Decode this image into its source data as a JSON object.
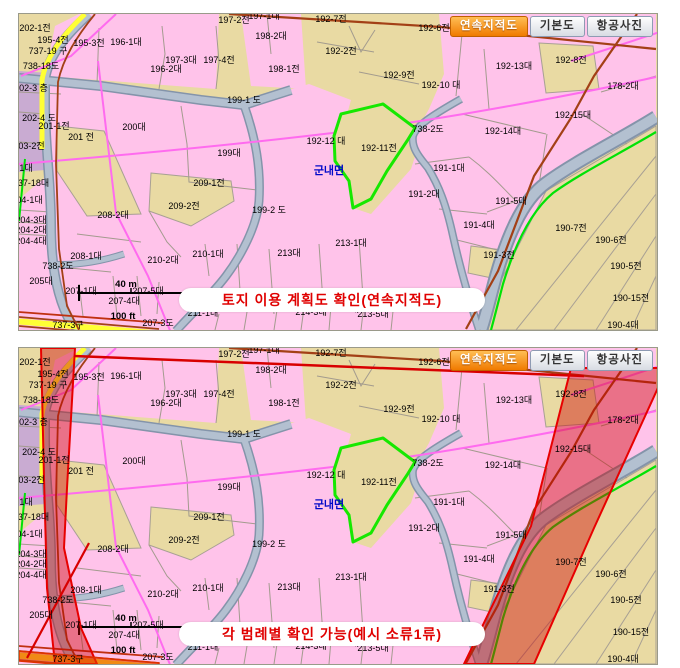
{
  "tabs": {
    "items": [
      {
        "label": "연속지적도",
        "active": true
      },
      {
        "label": "기본도",
        "active": false
      },
      {
        "label": "항공사진",
        "active": false
      }
    ]
  },
  "panels": [
    {
      "caption": "토지 이용 계획도 확인(연속지적도)"
    },
    {
      "caption": "각 범례별 확인 가능(예시 소류1류)"
    }
  ],
  "colors": {
    "parcel_pink": "#FFC3EA",
    "parcel_tan": "#E9DAA3",
    "parcel_purple": "#C9ABD2",
    "road_gray": "#B3C0D0",
    "road_yellow": "#FFFF35",
    "selected_outline_green": "#16E800",
    "zone_overlay_red": "#CC0000",
    "caption_red": "#E00000",
    "active_tab_orange": "#F07A00"
  },
  "scalebar": {
    "metric": "40 m",
    "imperial": "100 ft"
  },
  "map": {
    "town_label": "군내면",
    "labels": [
      {
        "t": "202-1전",
        "x": 16,
        "y": 17
      },
      {
        "t": "197-2전",
        "x": 215,
        "y": 9
      },
      {
        "t": "197-1대",
        "x": 245,
        "y": 5
      },
      {
        "t": "192-7전",
        "x": 312,
        "y": 8
      },
      {
        "t": "192-6전",
        "x": 415,
        "y": 17
      },
      {
        "t": "178-1대",
        "x": 610,
        "y": 20
      },
      {
        "t": "195-4전",
        "x": 34,
        "y": 29
      },
      {
        "t": "195-3전",
        "x": 70,
        "y": 32
      },
      {
        "t": "196-1대",
        "x": 107,
        "y": 31
      },
      {
        "t": "737-19 구",
        "x": 29,
        "y": 40
      },
      {
        "t": "198-2대",
        "x": 252,
        "y": 25
      },
      {
        "t": "192-2전",
        "x": 322,
        "y": 40
      },
      {
        "t": "738-18도",
        "x": 22,
        "y": 55
      },
      {
        "t": "197-3대",
        "x": 162,
        "y": 49
      },
      {
        "t": "197-4전",
        "x": 200,
        "y": 49
      },
      {
        "t": "196-2대",
        "x": 147,
        "y": 58
      },
      {
        "t": "192-8전",
        "x": 552,
        "y": 49
      },
      {
        "t": "192-13대",
        "x": 495,
        "y": 55
      },
      {
        "t": "198-1전",
        "x": 265,
        "y": 58
      },
      {
        "t": "192-9전",
        "x": 380,
        "y": 64
      },
      {
        "t": "192-10 대",
        "x": 422,
        "y": 74
      },
      {
        "t": "178-2대",
        "x": 604,
        "y": 75
      },
      {
        "t": "202-3 층",
        "x": 12,
        "y": 77
      },
      {
        "t": "199-1 도",
        "x": 225,
        "y": 89
      },
      {
        "t": "202-4 도",
        "x": 20,
        "y": 107
      },
      {
        "t": "201-1전",
        "x": 35,
        "y": 115
      },
      {
        "t": "200대",
        "x": 115,
        "y": 116
      },
      {
        "t": "738-2도",
        "x": 409,
        "y": 118
      },
      {
        "t": "192-14대",
        "x": 484,
        "y": 120
      },
      {
        "t": "192-15대",
        "x": 554,
        "y": 104
      },
      {
        "t": "192-12 대",
        "x": 307,
        "y": 130
      },
      {
        "t": "203-2전",
        "x": 10,
        "y": 135
      },
      {
        "t": "201 전",
        "x": 62,
        "y": 126
      },
      {
        "t": "192-11전",
        "x": 360,
        "y": 137
      },
      {
        "t": "199대",
        "x": 210,
        "y": 142
      },
      {
        "t": "군내면",
        "x": 310,
        "y": 160,
        "c": "town"
      },
      {
        "t": "191-1대",
        "x": 430,
        "y": 157
      },
      {
        "t": "203-1대",
        "x": -2,
        "y": 157
      },
      {
        "t": "737-18대",
        "x": 12,
        "y": 172
      },
      {
        "t": "209-1전",
        "x": 190,
        "y": 172
      },
      {
        "t": "191-2대",
        "x": 405,
        "y": 183
      },
      {
        "t": "191-5대",
        "x": 492,
        "y": 190
      },
      {
        "t": "204-1대",
        "x": 8,
        "y": 189
      },
      {
        "t": "209-2전",
        "x": 165,
        "y": 195
      },
      {
        "t": "199-2 도",
        "x": 250,
        "y": 199
      },
      {
        "t": "208-2대",
        "x": 94,
        "y": 204
      },
      {
        "t": "204-3대",
        "x": 12,
        "y": 209
      },
      {
        "t": "191-4대",
        "x": 460,
        "y": 214
      },
      {
        "t": "204-2대",
        "x": 12,
        "y": 219
      },
      {
        "t": "190-7전",
        "x": 552,
        "y": 217
      },
      {
        "t": "204-4대",
        "x": 12,
        "y": 230
      },
      {
        "t": "190-6전",
        "x": 592,
        "y": 229
      },
      {
        "t": "213-1대",
        "x": 332,
        "y": 232
      },
      {
        "t": "210-1대",
        "x": 189,
        "y": 243
      },
      {
        "t": "213대",
        "x": 270,
        "y": 242
      },
      {
        "t": "208-1대",
        "x": 67,
        "y": 245
      },
      {
        "t": "191-3전",
        "x": 480,
        "y": 244
      },
      {
        "t": "210-2대",
        "x": 144,
        "y": 249
      },
      {
        "t": "738-2도",
        "x": 39,
        "y": 255
      },
      {
        "t": "190-5전",
        "x": 607,
        "y": 255
      },
      {
        "t": "205대",
        "x": 22,
        "y": 270
      },
      {
        "t": "40 m",
        "x": 107,
        "y": 273,
        "c": "scale"
      },
      {
        "t": "207-1대",
        "x": 62,
        "y": 280
      },
      {
        "t": "207-5대",
        "x": 129,
        "y": 280
      },
      {
        "t": "207-4대",
        "x": 105,
        "y": 290
      },
      {
        "t": "190-15전",
        "x": 612,
        "y": 287
      },
      {
        "t": "100 ft",
        "x": 104,
        "y": 305,
        "c": "scale"
      },
      {
        "t": "211-1대",
        "x": 184,
        "y": 302
      },
      {
        "t": "212-1대",
        "x": 235,
        "y": 297
      },
      {
        "t": "214-3대",
        "x": 292,
        "y": 301
      },
      {
        "t": "214-1대",
        "x": 324,
        "y": 298
      },
      {
        "t": "213-5대",
        "x": 354,
        "y": 303
      },
      {
        "t": "190-4대",
        "x": 604,
        "y": 314
      },
      {
        "t": "737-3구",
        "x": 49,
        "y": 314
      },
      {
        "t": "207-3도",
        "x": 139,
        "y": 312
      }
    ]
  }
}
